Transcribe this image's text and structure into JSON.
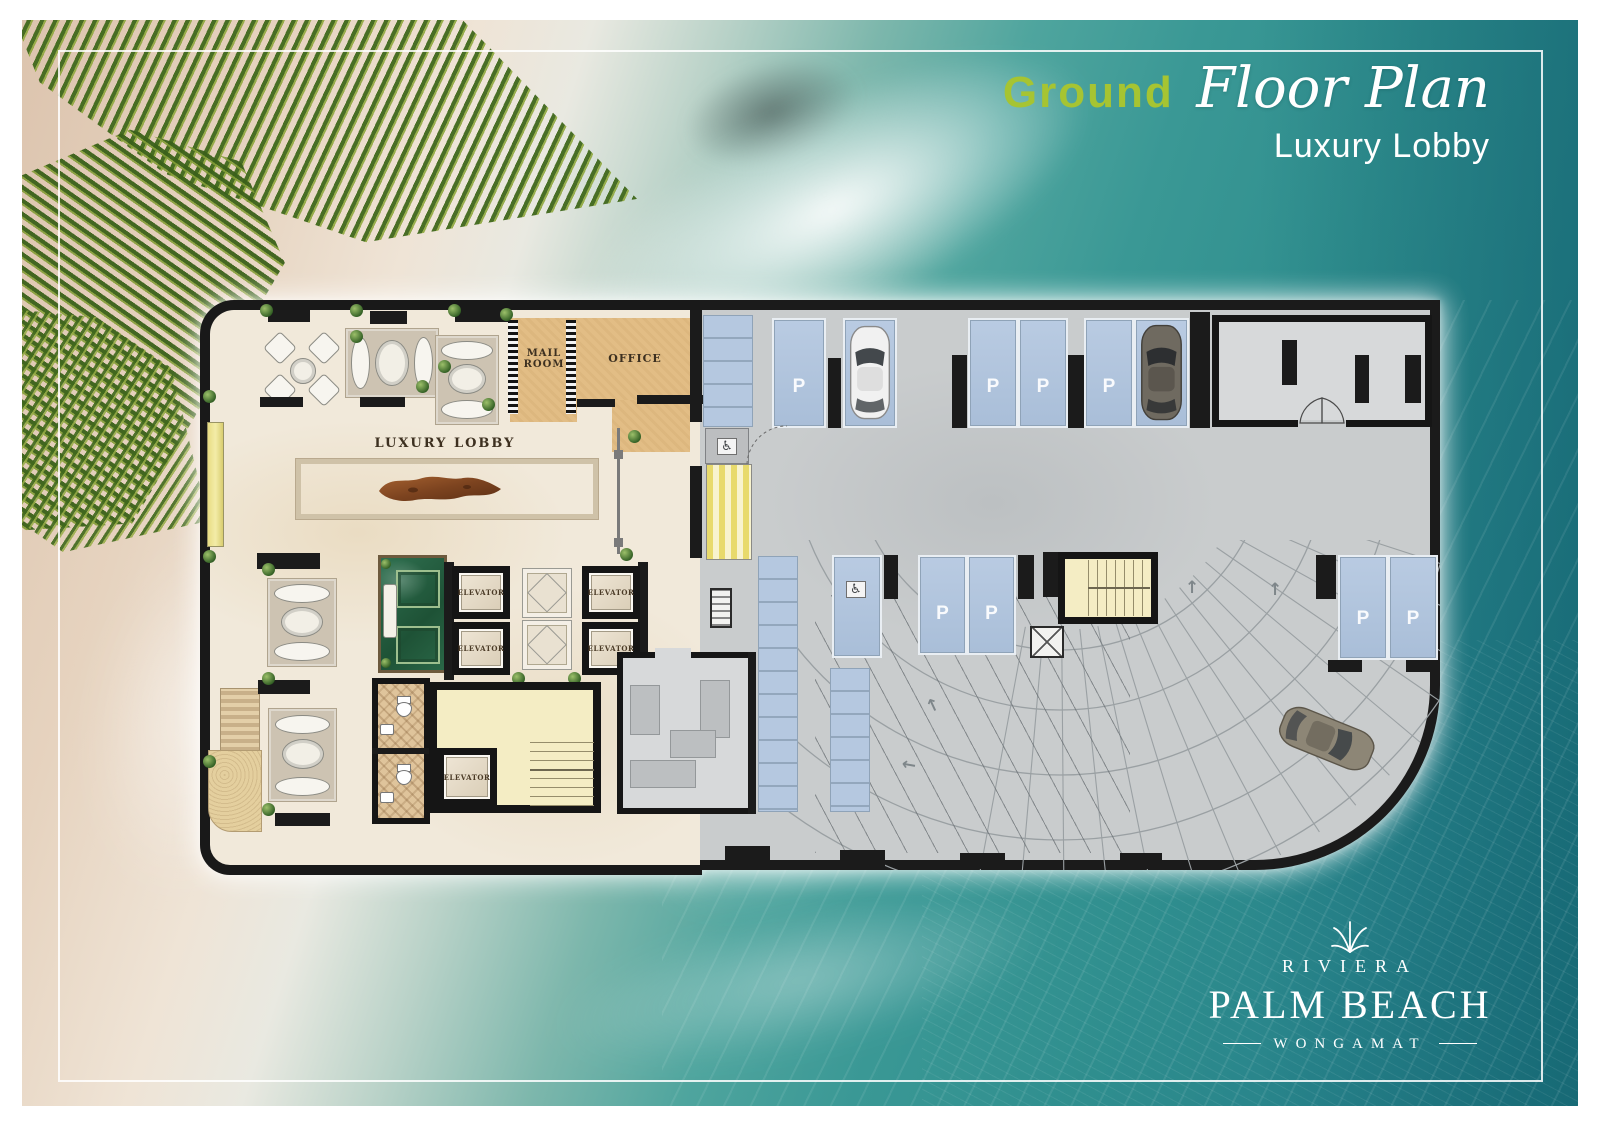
{
  "header": {
    "accent": "Ground",
    "script": "Floor Plan",
    "subtitle": "Luxury Lobby",
    "accent_color": "#a6c432"
  },
  "brand": {
    "name": "RIVIERA",
    "title": "PALM BEACH",
    "location": "WONGAMAT"
  },
  "plan": {
    "labels": {
      "mail_room": "MAIL ROOM",
      "office": "OFFICE",
      "lobby": "LUXURY LOBBY",
      "elevator": "ELEVATOR"
    },
    "parking": {
      "p": "P",
      "p_spot_count": 8,
      "accessible_icon": "♿",
      "arrow": "↑"
    }
  },
  "colors": {
    "accent_green": "#a6c432",
    "sea_teal": "#2f8e8e",
    "sand": "#e6d3bf",
    "wall_black": "#1b1b1b",
    "parking_spot_blue": "#b3c6de",
    "lobby_marble": "#f1e9da",
    "stair_yellow": "#f4edc4",
    "garden_green_marble": "#2f7050"
  }
}
